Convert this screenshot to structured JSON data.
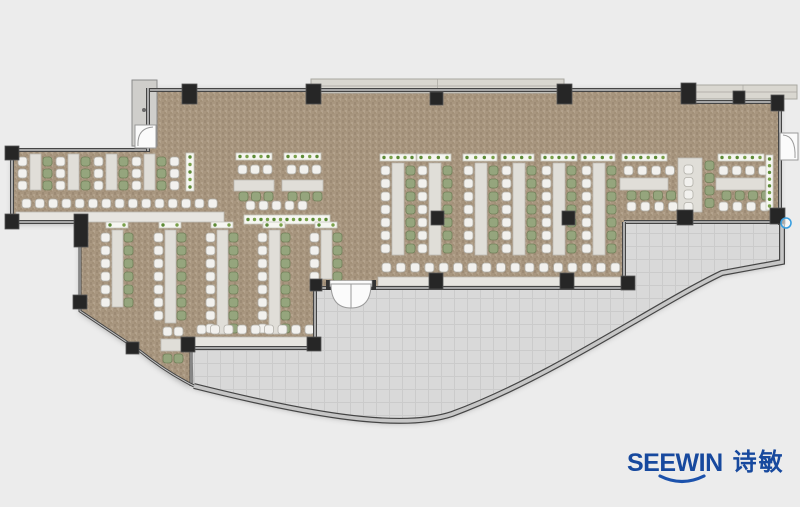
{
  "page": {
    "background": "#ececec"
  },
  "logo": {
    "brand": "SEEWIN",
    "brand_cn": "诗敏",
    "color": "#17499e",
    "swoosh_color": "#1c52ac"
  },
  "palette": {
    "background": "#ececec",
    "carpet": "#a8967f",
    "carpet_dark": "#9d8b75",
    "carpet_light": "#b3a28c",
    "carpet_mid": "#a29078",
    "terrace": "#d9d9d9",
    "terrace_line": "#cbcbcb",
    "terrace_edge": "#bdbdbd",
    "wall_dark": "#454545",
    "wall_light": "#c6c6c6",
    "column": "#262626",
    "column_edge": "#555555",
    "chair_white": "#f2f1ee",
    "chair_white_line": "#b3b1aa",
    "chair_green": "#95a57d",
    "chair_green_line": "#72815a",
    "table": "#e0ded8",
    "table_line": "#bdbbb4",
    "counter": "#e7e5e0",
    "planter": "#f6f6f1",
    "planter_line": "#c8c8c0",
    "planter_dot": "#5d8b36",
    "planter_dot_alt": "#79a04a",
    "deck": "#d9d7d0",
    "deck_line": "#a9a7a1",
    "panel": "#cfcecb",
    "door_white": "#fbfbfb",
    "door_line": "#9a9a9a",
    "marker_blue": "#3a9fe0"
  },
  "floorplan": {
    "outlines": {
      "carpet": "M147,88 L688,88 L688,102 L780,102 L780,222 L624,222 L624,288 L315,288 L315,348 L191,348 L191,386 Q163,371 140,351 L80,311 L80,222 L12,222 L12,150 L148,150 Z",
      "terrace": "M191,350 L316,350 L316,288 L624,288 L624,222 L782,222 L782,262 L722,273 C655,305 552,377 452,414 C398,432 298,412 194,386 Z"
    },
    "decks": [
      {
        "x": 311,
        "y": 79,
        "w": 253,
        "h": 14
      },
      {
        "x": 689,
        "y": 85,
        "w": 108,
        "h": 14
      }
    ],
    "panel": {
      "x": 132,
      "y": 80,
      "w": 25,
      "h": 66,
      "knobs": [
        [
          144,
          110
        ],
        [
          144,
          129
        ]
      ]
    },
    "items": [
      {
        "t": "table",
        "x": 30,
        "y": 154,
        "w": 11,
        "h": 36
      },
      {
        "t": "table",
        "x": 68,
        "y": 154,
        "w": 11,
        "h": 36
      },
      {
        "t": "table",
        "x": 106,
        "y": 154,
        "w": 11,
        "h": 36
      },
      {
        "t": "table",
        "x": 144,
        "y": 154,
        "w": 11,
        "h": 36
      },
      {
        "t": "chairs",
        "x": 18,
        "y": 157,
        "n": 3,
        "dy": 12,
        "c": "w"
      },
      {
        "t": "chairs",
        "x": 56,
        "y": 157,
        "n": 3,
        "dy": 12,
        "c": "w"
      },
      {
        "t": "chairs",
        "x": 94,
        "y": 157,
        "n": 3,
        "dy": 12,
        "c": "w"
      },
      {
        "t": "chairs",
        "x": 132,
        "y": 157,
        "n": 3,
        "dy": 12,
        "c": "w"
      },
      {
        "t": "chairs",
        "x": 170,
        "y": 157,
        "n": 3,
        "dy": 12,
        "c": "w"
      },
      {
        "t": "chairs",
        "x": 43,
        "y": 157,
        "n": 3,
        "dy": 12,
        "c": "g"
      },
      {
        "t": "chairs",
        "x": 81,
        "y": 157,
        "n": 3,
        "dy": 12,
        "c": "g"
      },
      {
        "t": "chairs",
        "x": 119,
        "y": 157,
        "n": 3,
        "dy": 12,
        "c": "g"
      },
      {
        "t": "chairs",
        "x": 157,
        "y": 157,
        "n": 3,
        "dy": 12,
        "c": "g"
      },
      {
        "t": "planter",
        "x": 186,
        "y": 153,
        "w": 8,
        "h": 38
      },
      {
        "t": "counter",
        "x": 16,
        "y": 212,
        "w": 208,
        "h": 10
      },
      {
        "t": "chairs",
        "x": 22,
        "y": 199,
        "n": 15,
        "dx": 13.3,
        "c": "w"
      },
      {
        "t": "planter",
        "x": 236,
        "y": 153,
        "w": 36,
        "h": 7
      },
      {
        "t": "chairs",
        "x": 238,
        "y": 165,
        "n": 3,
        "dx": 12.5,
        "c": "w"
      },
      {
        "t": "table",
        "x": 234,
        "y": 180,
        "w": 40,
        "h": 11
      },
      {
        "t": "chairs",
        "x": 239,
        "y": 192,
        "n": 3,
        "dx": 12.5,
        "c": "g"
      },
      {
        "t": "planter",
        "x": 284,
        "y": 153,
        "w": 37,
        "h": 7
      },
      {
        "t": "chairs",
        "x": 287,
        "y": 165,
        "n": 3,
        "dx": 12.5,
        "c": "w"
      },
      {
        "t": "table",
        "x": 282,
        "y": 180,
        "w": 41,
        "h": 11
      },
      {
        "t": "chairs",
        "x": 288,
        "y": 192,
        "n": 3,
        "dx": 12.5,
        "c": "g"
      },
      {
        "t": "chairs",
        "x": 246,
        "y": 201,
        "n": 5,
        "dx": 13,
        "c": "w"
      },
      {
        "t": "planter",
        "x": 244,
        "y": 215,
        "w": 86,
        "h": 9
      },
      {
        "t": "planter",
        "x": 106,
        "y": 222,
        "w": 22,
        "h": 6
      },
      {
        "t": "planter",
        "x": 159,
        "y": 222,
        "w": 22,
        "h": 6
      },
      {
        "t": "planter",
        "x": 211,
        "y": 222,
        "w": 22,
        "h": 6
      },
      {
        "t": "planter",
        "x": 263,
        "y": 222,
        "w": 22,
        "h": 6
      },
      {
        "t": "planter",
        "x": 315,
        "y": 222,
        "w": 22,
        "h": 6
      },
      {
        "t": "table",
        "x": 112,
        "y": 230,
        "w": 11,
        "h": 77
      },
      {
        "t": "table",
        "x": 165,
        "y": 230,
        "w": 11,
        "h": 93
      },
      {
        "t": "table",
        "x": 217,
        "y": 230,
        "w": 11,
        "h": 104
      },
      {
        "t": "table",
        "x": 269,
        "y": 230,
        "w": 11,
        "h": 104
      },
      {
        "t": "table",
        "x": 321,
        "y": 230,
        "w": 11,
        "h": 49
      },
      {
        "t": "chairs",
        "x": 101,
        "y": 233,
        "n": 6,
        "dy": 13,
        "c": "w"
      },
      {
        "t": "chairs",
        "x": 154,
        "y": 233,
        "n": 7,
        "dy": 13,
        "c": "w"
      },
      {
        "t": "chairs",
        "x": 206,
        "y": 233,
        "n": 8,
        "dy": 13,
        "c": "w"
      },
      {
        "t": "chairs",
        "x": 258,
        "y": 233,
        "n": 8,
        "dy": 13,
        "c": "w"
      },
      {
        "t": "chairs",
        "x": 310,
        "y": 233,
        "n": 4,
        "dy": 13,
        "c": "w"
      },
      {
        "t": "chairs",
        "x": 124,
        "y": 233,
        "n": 6,
        "dy": 13,
        "c": "g"
      },
      {
        "t": "chairs",
        "x": 177,
        "y": 233,
        "n": 7,
        "dy": 13,
        "c": "g"
      },
      {
        "t": "chairs",
        "x": 229,
        "y": 233,
        "n": 8,
        "dy": 13,
        "c": "g"
      },
      {
        "t": "chairs",
        "x": 281,
        "y": 233,
        "n": 8,
        "dy": 13,
        "c": "g"
      },
      {
        "t": "chairs",
        "x": 333,
        "y": 233,
        "n": 4,
        "dy": 13,
        "c": "g"
      },
      {
        "t": "counter",
        "x": 194,
        "y": 337,
        "w": 122,
        "h": 10
      },
      {
        "t": "chairs",
        "x": 197,
        "y": 325,
        "n": 9,
        "dx": 13.5,
        "c": "w"
      },
      {
        "t": "chairs",
        "x": 163,
        "y": 327,
        "n": 2,
        "dx": 11,
        "c": "w"
      },
      {
        "t": "table",
        "x": 161,
        "y": 339,
        "w": 23,
        "h": 12
      },
      {
        "t": "chairs",
        "x": 163,
        "y": 354,
        "n": 2,
        "dx": 11,
        "c": "g"
      },
      {
        "t": "planter",
        "x": 380,
        "y": 154,
        "w": 36,
        "h": 7
      },
      {
        "t": "planter",
        "x": 417,
        "y": 154,
        "w": 34,
        "h": 7
      },
      {
        "t": "planter",
        "x": 463,
        "y": 154,
        "w": 34,
        "h": 7
      },
      {
        "t": "planter",
        "x": 501,
        "y": 154,
        "w": 33,
        "h": 7
      },
      {
        "t": "planter",
        "x": 541,
        "y": 154,
        "w": 36,
        "h": 7
      },
      {
        "t": "planter",
        "x": 581,
        "y": 154,
        "w": 34,
        "h": 7
      },
      {
        "t": "table",
        "x": 392,
        "y": 163,
        "w": 12,
        "h": 92
      },
      {
        "t": "table",
        "x": 429,
        "y": 163,
        "w": 12,
        "h": 92
      },
      {
        "t": "table",
        "x": 475,
        "y": 163,
        "w": 12,
        "h": 92
      },
      {
        "t": "table",
        "x": 513,
        "y": 163,
        "w": 12,
        "h": 92
      },
      {
        "t": "table",
        "x": 553,
        "y": 163,
        "w": 12,
        "h": 92
      },
      {
        "t": "table",
        "x": 593,
        "y": 163,
        "w": 12,
        "h": 92
      },
      {
        "t": "chairs",
        "x": 381,
        "y": 166,
        "n": 7,
        "dy": 13,
        "c": "w"
      },
      {
        "t": "chairs",
        "x": 418,
        "y": 166,
        "n": 7,
        "dy": 13,
        "c": "w"
      },
      {
        "t": "chairs",
        "x": 464,
        "y": 166,
        "n": 7,
        "dy": 13,
        "c": "w"
      },
      {
        "t": "chairs",
        "x": 502,
        "y": 166,
        "n": 7,
        "dy": 13,
        "c": "w"
      },
      {
        "t": "chairs",
        "x": 542,
        "y": 166,
        "n": 7,
        "dy": 13,
        "c": "w"
      },
      {
        "t": "chairs",
        "x": 582,
        "y": 166,
        "n": 7,
        "dy": 13,
        "c": "w"
      },
      {
        "t": "chairs",
        "x": 406,
        "y": 166,
        "n": 7,
        "dy": 13,
        "c": "g"
      },
      {
        "t": "chairs",
        "x": 443,
        "y": 166,
        "n": 7,
        "dy": 13,
        "c": "g"
      },
      {
        "t": "chairs",
        "x": 489,
        "y": 166,
        "n": 7,
        "dy": 13,
        "c": "g"
      },
      {
        "t": "chairs",
        "x": 527,
        "y": 166,
        "n": 7,
        "dy": 13,
        "c": "g"
      },
      {
        "t": "chairs",
        "x": 567,
        "y": 166,
        "n": 7,
        "dy": 13,
        "c": "g"
      },
      {
        "t": "chairs",
        "x": 607,
        "y": 166,
        "n": 7,
        "dy": 13,
        "c": "g"
      },
      {
        "t": "counter",
        "x": 378,
        "y": 277,
        "w": 248,
        "h": 9
      },
      {
        "t": "chairs",
        "x": 382,
        "y": 263,
        "n": 17,
        "dx": 14.3,
        "c": "w"
      },
      {
        "t": "planter",
        "x": 622,
        "y": 154,
        "w": 45,
        "h": 7
      },
      {
        "t": "chairs",
        "x": 624,
        "y": 166,
        "n": 4,
        "dx": 13.8,
        "c": "w"
      },
      {
        "t": "table",
        "x": 620,
        "y": 178,
        "w": 48,
        "h": 12
      },
      {
        "t": "chairs",
        "x": 627,
        "y": 191,
        "n": 4,
        "dx": 13.2,
        "c": "g"
      },
      {
        "t": "chairs",
        "x": 627,
        "y": 202,
        "n": 4,
        "dx": 13.8,
        "c": "w"
      },
      {
        "t": "table",
        "x": 678,
        "y": 158,
        "w": 24,
        "h": 54
      },
      {
        "t": "chairs",
        "x": 684,
        "y": 165,
        "n": 4,
        "dy": 12.5,
        "c": "w"
      },
      {
        "t": "chairs",
        "x": 705,
        "y": 161,
        "n": 4,
        "dy": 12.5,
        "c": "g"
      },
      {
        "t": "planter",
        "x": 718,
        "y": 154,
        "w": 46,
        "h": 7
      },
      {
        "t": "chairs",
        "x": 719,
        "y": 166,
        "n": 4,
        "dx": 13.2,
        "c": "w"
      },
      {
        "t": "table",
        "x": 716,
        "y": 178,
        "w": 49,
        "h": 12
      },
      {
        "t": "chairs",
        "x": 722,
        "y": 191,
        "n": 4,
        "dx": 13.2,
        "c": "g"
      },
      {
        "t": "chairs",
        "x": 719,
        "y": 202,
        "n": 4,
        "dx": 13.8,
        "c": "w"
      },
      {
        "t": "planter",
        "x": 766,
        "y": 155,
        "w": 7,
        "h": 55
      }
    ],
    "walls": [
      {
        "d": "M147,90 L688,90 L688,102 L780,102 L780,225",
        "w": 4
      },
      {
        "d": "M624,222 L781,222",
        "w": 4
      },
      {
        "d": "M624,222 L624,288",
        "w": 4
      },
      {
        "d": "M315,288 L625,288",
        "w": 4
      },
      {
        "d": "M315,288 L315,348",
        "w": 4
      },
      {
        "d": "M191,348 L316,348",
        "w": 4
      },
      {
        "d": "M191,348 L191,386",
        "w": 3
      },
      {
        "d": "M80,228 L80,311 L140,351 Q166,372 194,386",
        "w": 3
      },
      {
        "d": "M12,222 L81,222",
        "w": 4
      },
      {
        "d": "M12,150 L12,223",
        "w": 4
      },
      {
        "d": "M12,150 L150,150",
        "w": 4
      },
      {
        "d": "M148,88 L148,151",
        "w": 4
      },
      {
        "d": "M782,224 L782,262 L722,273 C655,305 552,377 452,414 C398,432 298,412 194,386",
        "w": 6
      }
    ],
    "columns": [
      [
        182,
        84,
        15,
        20
      ],
      [
        306,
        84,
        15,
        20
      ],
      [
        430,
        92,
        13,
        13
      ],
      [
        557,
        84,
        15,
        20
      ],
      [
        681,
        83,
        15,
        21
      ],
      [
        733,
        91,
        12,
        13
      ],
      [
        771,
        95,
        13,
        16
      ],
      [
        770,
        208,
        15,
        16
      ],
      [
        677,
        210,
        16,
        15
      ],
      [
        621,
        276,
        14,
        14
      ],
      [
        560,
        273,
        14,
        16
      ],
      [
        429,
        273,
        14,
        16
      ],
      [
        310,
        279,
        12,
        12
      ],
      [
        307,
        337,
        14,
        14
      ],
      [
        181,
        337,
        14,
        15
      ],
      [
        126,
        342,
        13,
        12
      ],
      [
        73,
        295,
        14,
        14
      ],
      [
        74,
        214,
        14,
        33
      ],
      [
        5,
        214,
        14,
        15
      ],
      [
        5,
        146,
        14,
        14
      ],
      [
        431,
        211,
        13,
        14
      ],
      [
        562,
        211,
        13,
        14
      ]
    ],
    "doors": [
      {
        "kind": "double",
        "x": 331,
        "y": 284,
        "w": 40,
        "h": 24
      },
      {
        "kind": "right",
        "x": 780,
        "y": 133,
        "w": 18,
        "h": 27
      },
      {
        "kind": "left",
        "x": 135,
        "y": 125,
        "w": 21,
        "h": 23
      }
    ],
    "marker": {
      "x": 786,
      "y": 223,
      "r": 5
    }
  }
}
